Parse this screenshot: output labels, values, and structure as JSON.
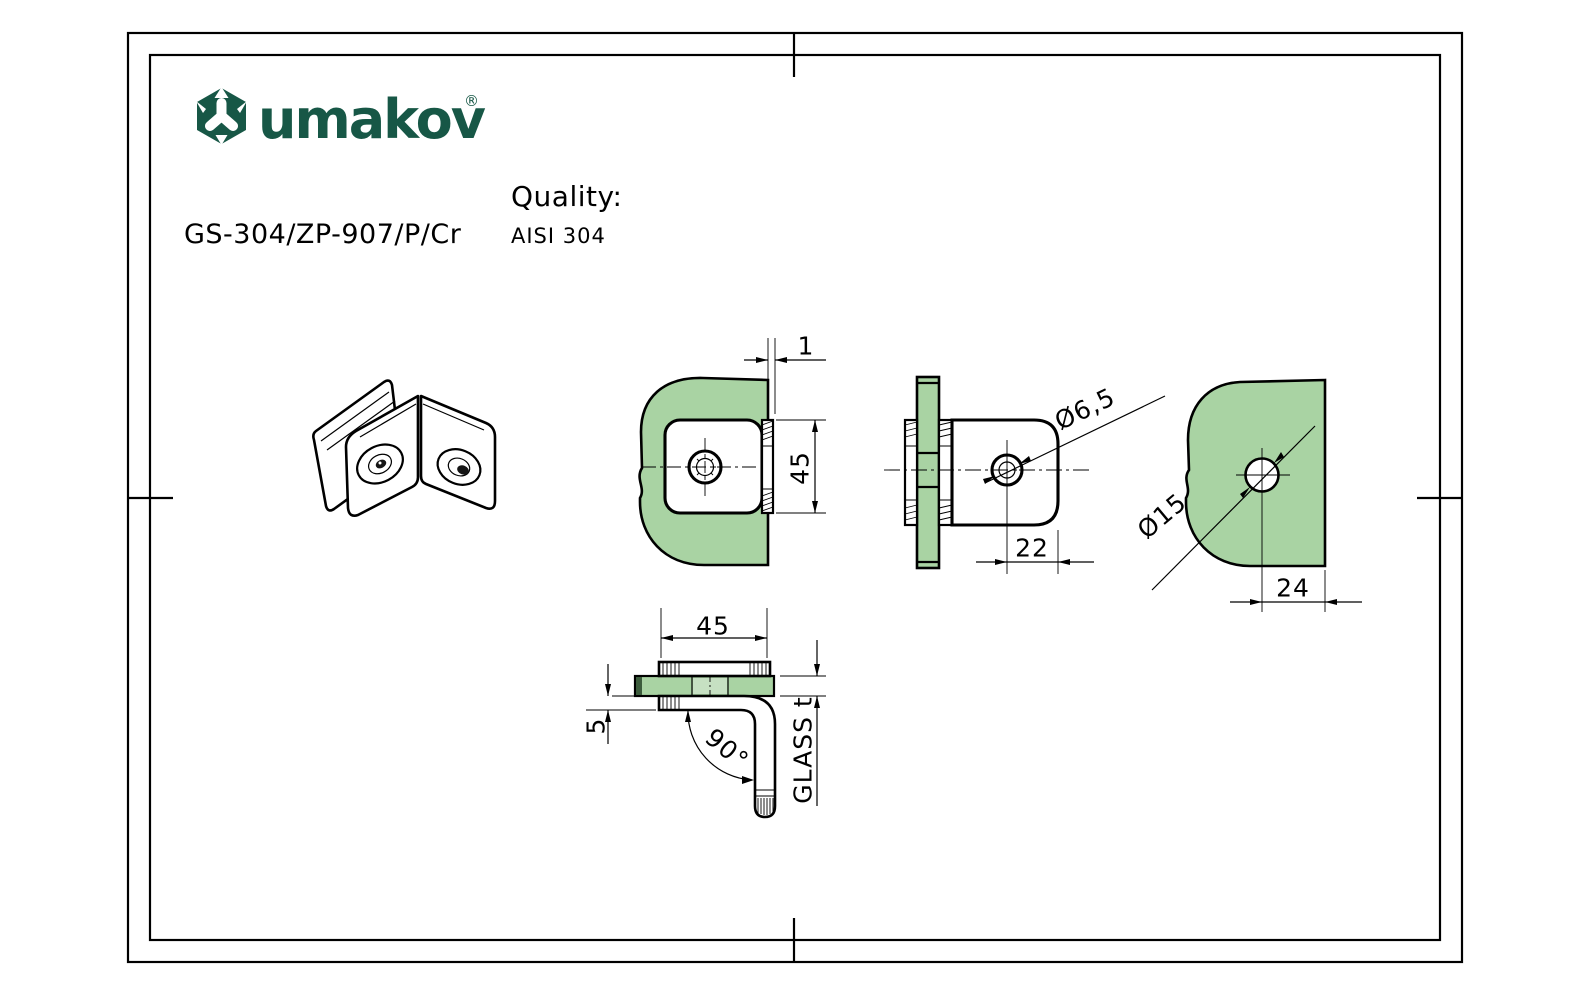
{
  "title_block": {
    "brand": "umakov",
    "registered_mark": "®",
    "part_number": "GS-304/ZP-907/P/Cr",
    "quality_label": "Quality:",
    "quality_value": "AISI 304",
    "logo_icon": "umakov-hexagon-logo"
  },
  "colors": {
    "brand_green": "#175746",
    "glass_green": "#a9d3a3",
    "glass_green_light": "#c6e0c2",
    "glass_green_dark": "#3c5c3c",
    "line": "#000000"
  },
  "drawing": {
    "dimensions": {
      "glass_edge_offset": "1",
      "plate_height": "45",
      "screw_hole_diameter": "Ø6,5",
      "hole_to_edge": "22",
      "glass_hole_diameter": "Ø15",
      "glass_hole_to_edge": "24",
      "plate_width": "45",
      "plate_thickness": "5",
      "bracket_angle": "90°",
      "glass_thickness": "GLASS t"
    }
  }
}
